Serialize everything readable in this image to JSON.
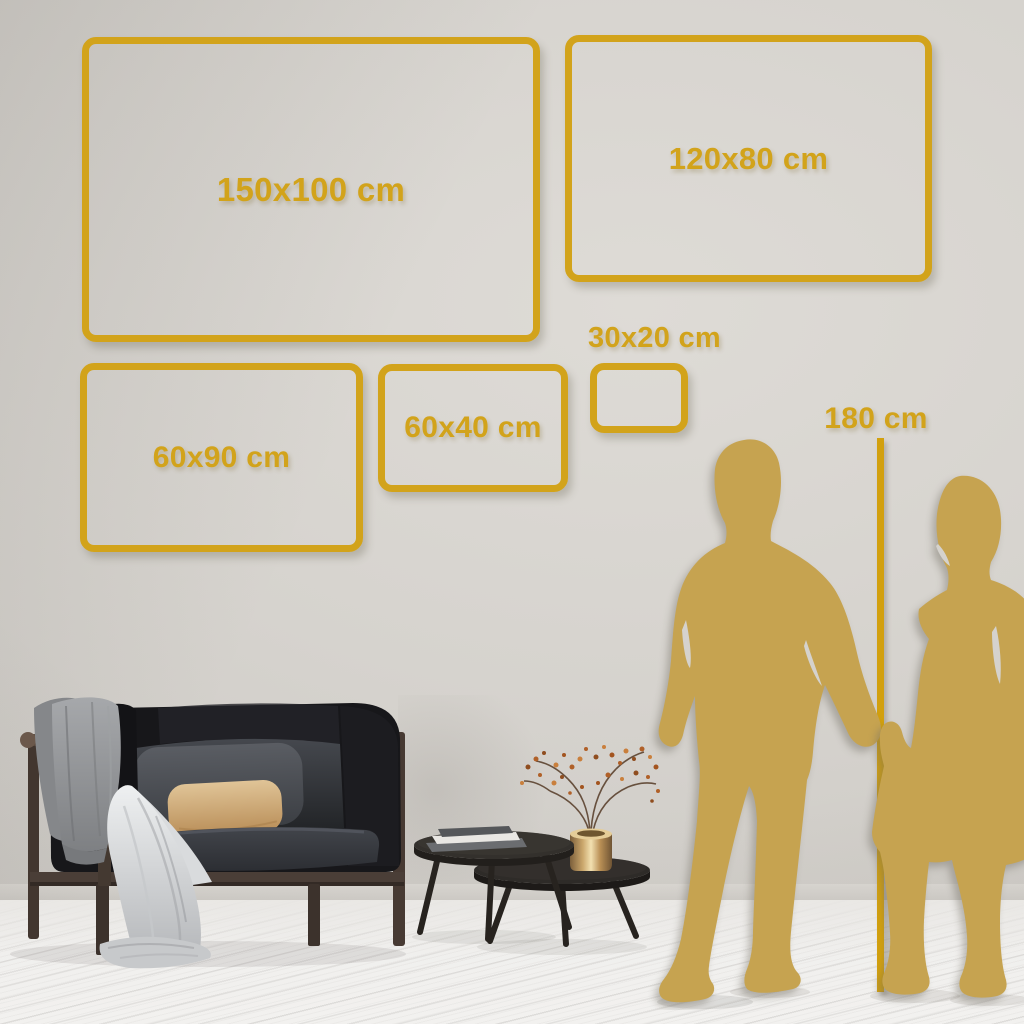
{
  "frames": [
    {
      "name": "frame-150x100",
      "label": "150x100 cm"
    },
    {
      "name": "frame-120x80",
      "label": "120x80 cm"
    },
    {
      "name": "frame-30x20",
      "label": "30x20 cm"
    },
    {
      "name": "frame-60x40",
      "label": "60x40 cm"
    },
    {
      "name": "frame-60x90",
      "label": "60x90 cm"
    }
  ],
  "height_marker": {
    "label": "180 cm"
  },
  "colors": {
    "accent_gold": "#D2A31B",
    "silhouette_gold": "#C6A350",
    "wall": "#D3D0CB",
    "floor": "#F1F0EE"
  },
  "scene": {
    "objects": [
      "sofa",
      "throw-blanket",
      "gray-cushion",
      "beige-cushion",
      "nesting-coffee-tables",
      "books",
      "brass-vase",
      "dried-branch",
      "man-silhouette",
      "woman-silhouette",
      "height-reference-line"
    ]
  }
}
